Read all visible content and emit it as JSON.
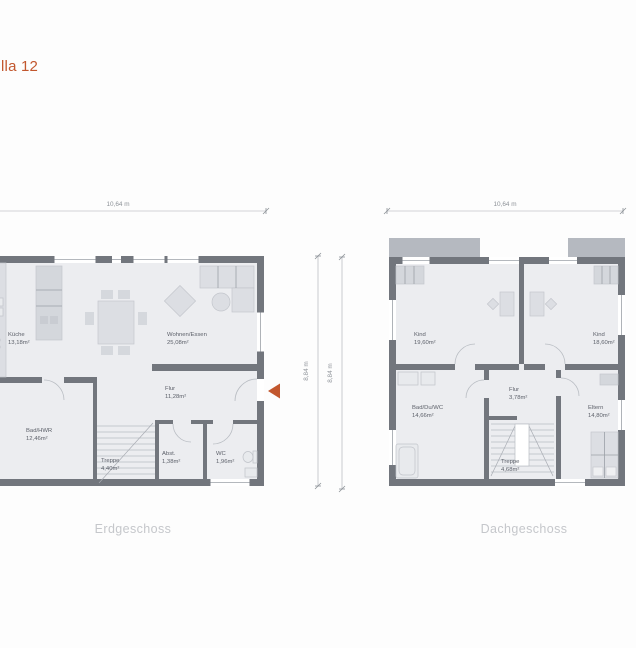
{
  "title": "lla 12",
  "colors": {
    "accent": "#c2572e",
    "wall": "#72767d",
    "floor": "#ecedf0",
    "roof_block": "#b5b9c0",
    "caption_text": "#c5c7cb",
    "dimension_text": "#8d9298",
    "room_label_text": "#5d616a"
  },
  "floorplans": [
    {
      "caption": "Erdgeschoss",
      "dim_width": "10,64 m",
      "dim_height": "8,84 m",
      "rooms": [
        {
          "name": "Küche",
          "area": "13,18m²"
        },
        {
          "name": "Wohnen/Essen",
          "area": "25,08m²"
        },
        {
          "name": "Flur",
          "area": "11,28m²"
        },
        {
          "name": "Bad/HWR",
          "area": "12,46m²"
        },
        {
          "name": "Treppe",
          "area": "4,40m²"
        },
        {
          "name": "Abst.",
          "area": "1,38m²"
        },
        {
          "name": "WC",
          "area": "1,96m²"
        }
      ]
    },
    {
      "caption": "Dachgeschoss",
      "dim_width": "10,64 m",
      "dim_height": "8,84 m",
      "rooms": [
        {
          "name": "Kind",
          "area": "19,60m²"
        },
        {
          "name": "Kind",
          "area": "18,60m²"
        },
        {
          "name": "Bad/Du/WC",
          "area": "14,66m²"
        },
        {
          "name": "Flur",
          "area": "3,78m²"
        },
        {
          "name": "Eltern",
          "area": "14,80m²"
        },
        {
          "name": "Treppe",
          "area": "4,68m²"
        }
      ]
    }
  ]
}
